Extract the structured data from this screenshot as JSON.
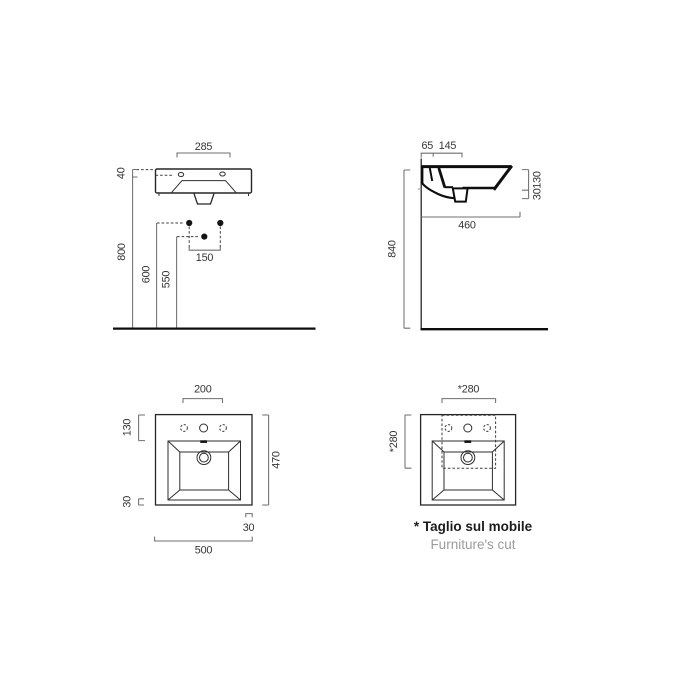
{
  "drawing": {
    "type": "washbasin technical drawing",
    "front_view": {
      "top_width": "285",
      "rim_height": "40",
      "install_height": "800",
      "drain_line_height": "600",
      "siphon_height": "550",
      "fixing_holes_spacing": "150"
    },
    "side_view": {
      "tap_edge_offset": "65",
      "tap_spacing": "145",
      "basin_front_height": "130",
      "ledge_thickness": "30",
      "overall_depth": "460",
      "install_height": "840"
    },
    "plan_view": {
      "tap_zone_width": "200",
      "tap_zone_depth": "130",
      "overall_depth": "470",
      "rim_side": "30",
      "rim_corner": "30",
      "overall_width": "500"
    },
    "cut_view": {
      "cut_width": "*280",
      "cut_depth": "*280",
      "note_italian": "* Taglio sul mobile",
      "note_english": "Furniture's cut"
    },
    "colors": {
      "background": "#ffffff",
      "object_line": "#262626",
      "dimension_line": "#6f6f6f",
      "text": "#353535",
      "caption_secondary": "#9b9b9b"
    }
  }
}
